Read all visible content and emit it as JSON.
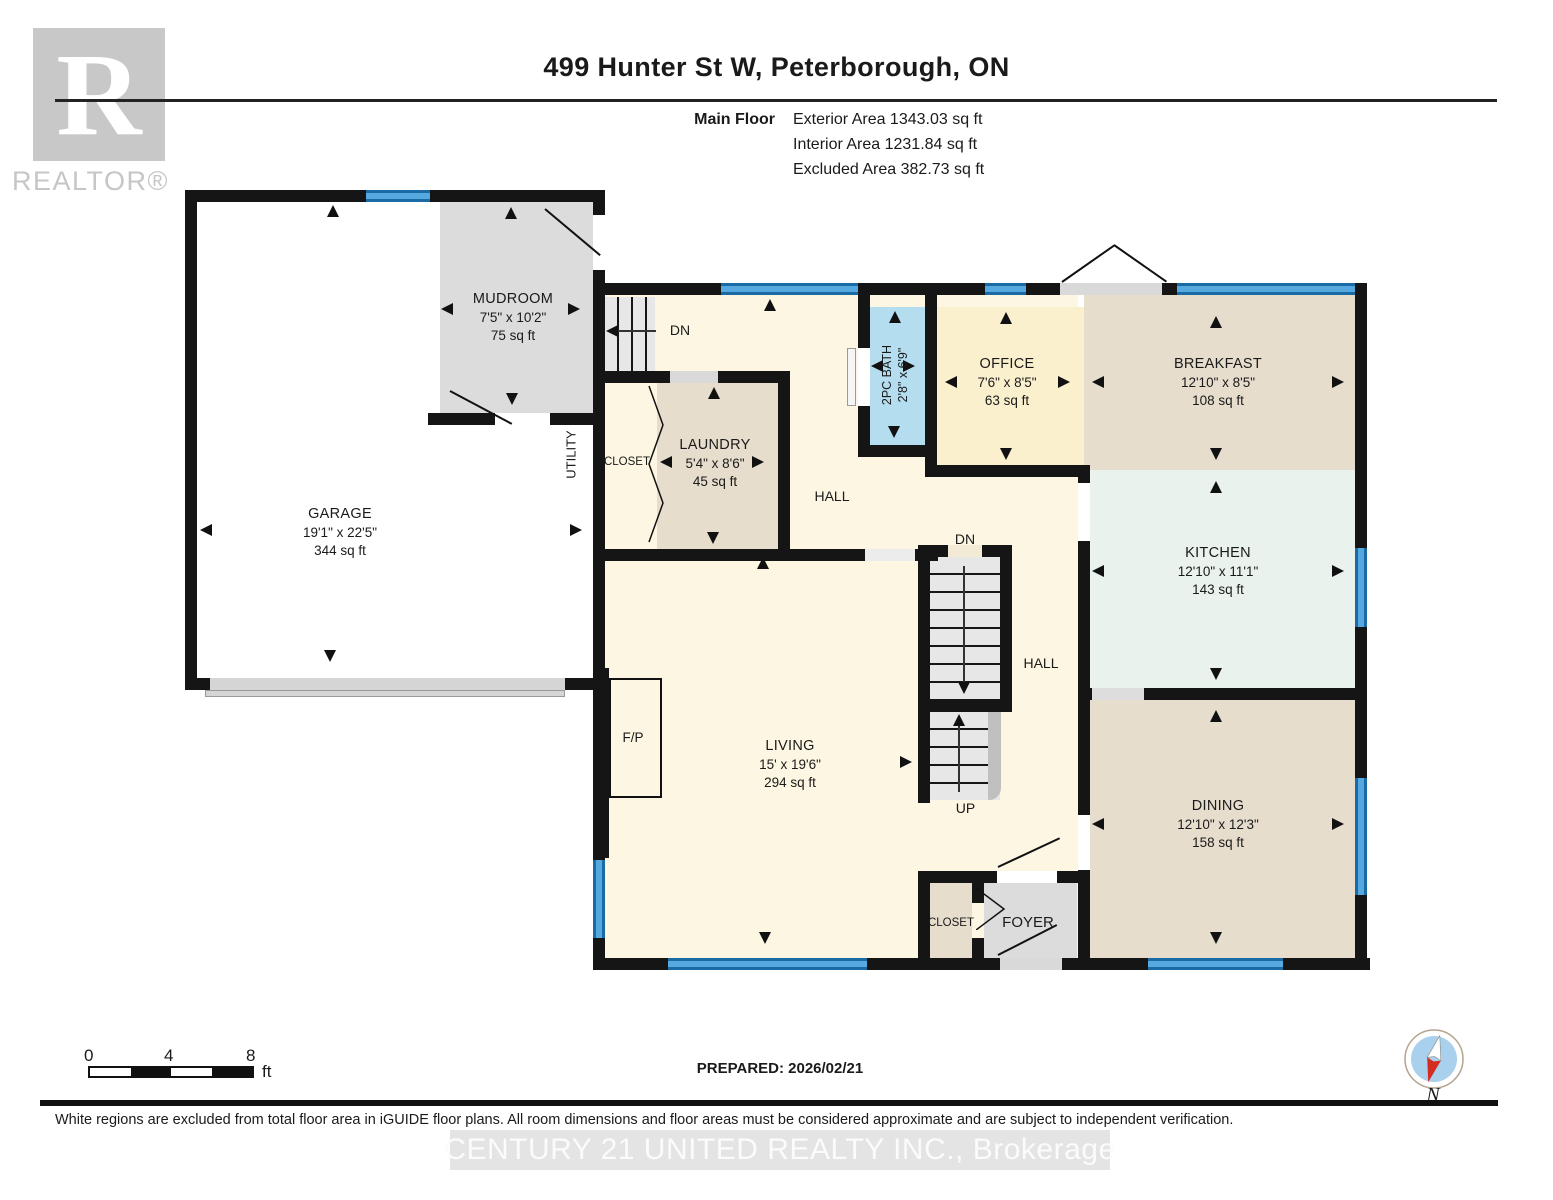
{
  "header": {
    "title": "499 Hunter St W, Peterborough, ON",
    "floor_label": "Main Floor",
    "exterior_area": "Exterior Area 1343.03 sq ft",
    "interior_area": "Interior Area 1231.84 sq ft",
    "excluded_area": "Excluded Area 382.73 sq ft"
  },
  "logo": {
    "letter": "R",
    "text": "REALTOR®"
  },
  "rooms": [
    {
      "name": "GARAGE",
      "dims": "19'1\" x 22'5\"",
      "area": "344 sq ft"
    },
    {
      "name": "MUDROOM",
      "dims": "7'5\" x 10'2\"",
      "area": "75 sq ft"
    },
    {
      "name": "LAUNDRY",
      "dims": "5'4\" x 8'6\"",
      "area": "45 sq ft"
    },
    {
      "name": "2PC BATH",
      "dims": "2'8\" x 6'9\"",
      "area": ""
    },
    {
      "name": "OFFICE",
      "dims": "7'6\" x 8'5\"",
      "area": "63 sq ft"
    },
    {
      "name": "BREAKFAST",
      "dims": "12'10\" x 8'5\"",
      "area": "108 sq ft"
    },
    {
      "name": "KITCHEN",
      "dims": "12'10\" x 11'1\"",
      "area": "143 sq ft"
    },
    {
      "name": "DINING",
      "dims": "12'10\" x 12'3\"",
      "area": "158 sq ft"
    },
    {
      "name": "LIVING",
      "dims": "15' x 19'6\"",
      "area": "294 sq ft"
    }
  ],
  "labels": {
    "hall_upper": "HALL",
    "hall_lower": "HALL",
    "closet_laundry": "CLOSET",
    "closet_foyer": "CLOSET",
    "foyer": "FOYER",
    "utility": "UTILITY",
    "fireplace": "F/P",
    "dn_upper": "DN",
    "dn_stairs": "DN",
    "up_stairs": "UP"
  },
  "footer": {
    "scale_0": "0",
    "scale_4": "4",
    "scale_8": "8",
    "scale_unit": "ft",
    "prepared": "PREPARED: 2026/02/21",
    "compass_n": "N",
    "disclaimer": "White regions are excluded from total floor area in iGUIDE floor plans. All room dimensions and floor areas must be considered approximate and are subject to independent verification.",
    "watermark": "CENTURY 21 UNITED REALTY INC., Brokerage"
  },
  "colors": {
    "wall": "#151515",
    "window_blue": "#56a9de",
    "bath_blue": "#b5ddf0",
    "cream": "#fdf6e2",
    "office_yellow": "#fbf0ce",
    "tan": "#e6ddcd",
    "kitchen_mint": "#e9f2ec",
    "gray_room": "#dcdcdc"
  }
}
